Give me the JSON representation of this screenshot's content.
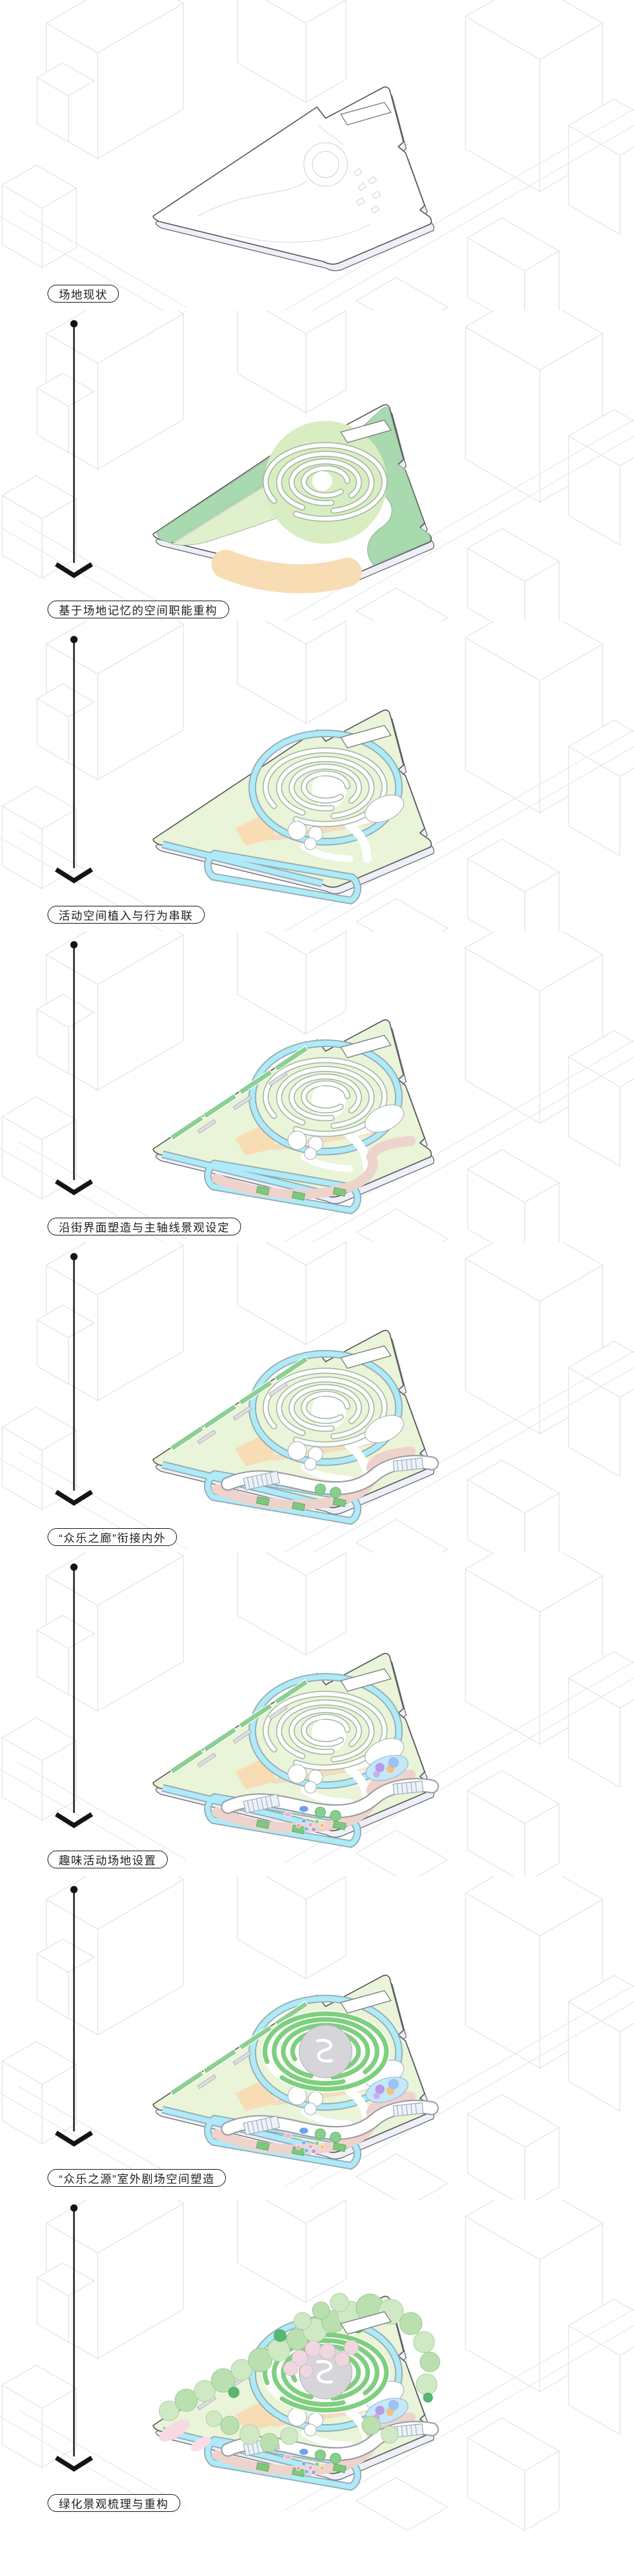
{
  "page": {
    "background": "#ffffff"
  },
  "stages": [
    {
      "label": "场地现状",
      "layers": [
        "slab",
        "plot-white",
        "faint-detail",
        "notch"
      ]
    },
    {
      "label": "基于场地记忆的空间职能重构",
      "layers": [
        "slab",
        "plot-white",
        "zone-band",
        "zone-mid",
        "zone-right",
        "arc-disc",
        "arcs",
        "orange-band",
        "notch"
      ]
    },
    {
      "label": "活动空间植入与行为串联",
      "layers": [
        "slab",
        "plot-green",
        "orange-small",
        "cyan",
        "paths-white",
        "arcs",
        "pond",
        "circles3",
        "notch"
      ]
    },
    {
      "label": "沿街界面塑造与主轴线景观设定",
      "layers": [
        "slab",
        "plot-green",
        "orange-small",
        "cyan",
        "paths-white",
        "arcs",
        "pond",
        "circles3",
        "street-planters",
        "axis-pink",
        "axis-planters",
        "notch"
      ]
    },
    {
      "label": "“众乐之廊”衔接内外",
      "layers": [
        "slab",
        "plot-green",
        "orange-small",
        "cyan",
        "paths-white",
        "arcs",
        "pond",
        "circles3",
        "street-planters",
        "axis-pink",
        "axis-planters",
        "canopy",
        "notch"
      ]
    },
    {
      "label": "趣味活动场地设置",
      "layers": [
        "slab",
        "plot-green",
        "orange-small",
        "cyan",
        "paths-white",
        "arcs",
        "pond",
        "circles3",
        "street-planters",
        "axis-pink",
        "axis-planters",
        "canopy",
        "play",
        "notch"
      ]
    },
    {
      "label": "“众乐之源”室外剧场空间塑造",
      "layers": [
        "slab",
        "plot-green",
        "orange-small",
        "cyan",
        "paths-white",
        "pond",
        "circles3",
        "street-planters",
        "axis-pink",
        "axis-planters",
        "amphi",
        "canopy",
        "play",
        "notch"
      ]
    },
    {
      "label": "绿化景观梳理与重构",
      "layers": [
        "slab",
        "plot-green",
        "orange-small",
        "cyan",
        "paths-white",
        "pond",
        "circles3",
        "street-planters",
        "axis-pink",
        "axis-planters",
        "amphi",
        "canopy",
        "play",
        "paving",
        "trees",
        "notch"
      ]
    }
  ],
  "arrows": {
    "count": 7,
    "icon": "down-arrow"
  },
  "palette": {
    "page_bg": "#ffffff",
    "label_ink": "#1c1c1c",
    "arrow_ink": "#141414",
    "site_outline": "#565656",
    "background_lines": "#dcdce6",
    "green_band": "#a9d9ae",
    "green_light": "#dff0cd",
    "green_pale": "#e9f4d8",
    "arc_fill": "#d9edc2",
    "orange": "#f8ddb4",
    "cyan": "#aeeaf8",
    "pink_axis": "#eed3cc",
    "planter_green": "#8ccf92",
    "canopy_white": "#ffffff",
    "canopy_edge": "#9a9aa2",
    "amphi_ring": "#7ecf7e",
    "amphi_center": "#d6d6da",
    "tree_green_light": "#cfe9c4",
    "tree_green_mid": "#b9e0ae",
    "tree_pink": "#eed7df",
    "accent_green": "#58b873",
    "play_blue": "#7fb3f2",
    "play_purple": "#b79ae8",
    "play_orange": "#f5c27a",
    "play_pink": "#f2a4c0",
    "slab_side": "#eef0f7"
  }
}
